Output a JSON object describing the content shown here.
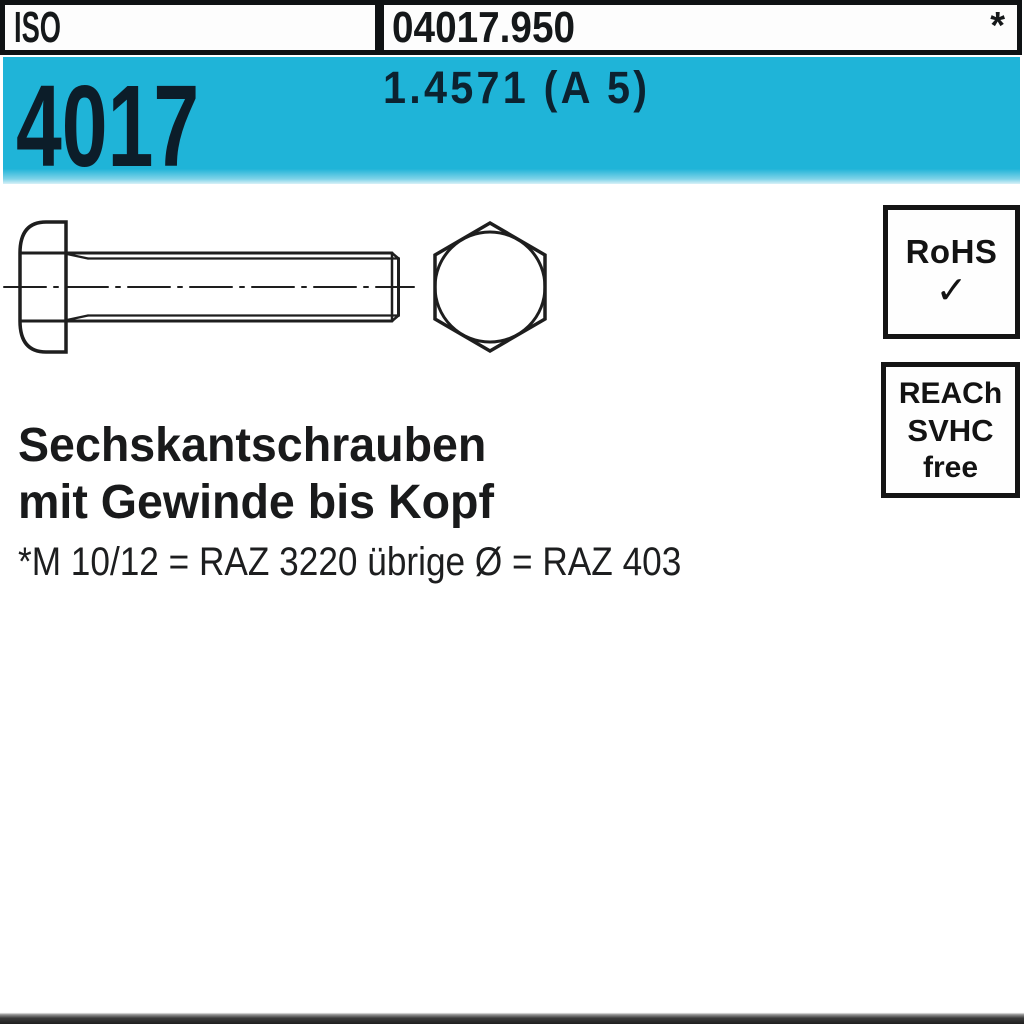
{
  "header": {
    "standard_org": "ISO",
    "article_number": "04017.950",
    "footnote_marker": "*"
  },
  "banner": {
    "standard_number": "4017",
    "material_grade": "1.4571 (A 5)"
  },
  "drawing": {
    "type": "technical line drawing",
    "subject": "hex head bolt, side view with full thread and hexagon end view"
  },
  "badges": {
    "rohs": {
      "label": "RoHS",
      "checkmark": "✓"
    },
    "reach": {
      "line1": "REACh",
      "line2": "SVHC",
      "line3": "free"
    }
  },
  "product": {
    "title_line1": "Sechskantschrauben",
    "title_line2": "mit Gewinde bis Kopf",
    "footnote": "*M 10/12 = RAZ 3220 übrige Ø = RAZ 403"
  },
  "colors": {
    "banner_cyan": "#1fb4d8",
    "banner_text": "#0c1d29",
    "ink": "#1e1e1e",
    "background": "#ffffff"
  }
}
